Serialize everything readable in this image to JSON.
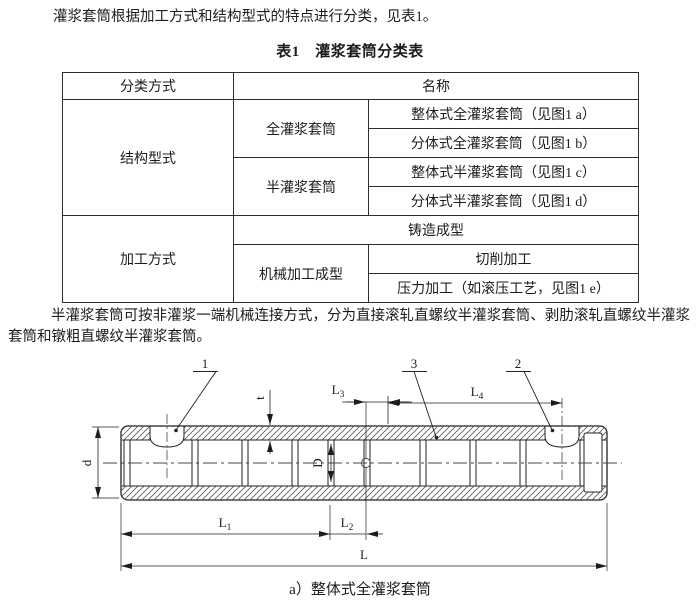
{
  "page": {
    "intro": "灌浆套筒根据加工方式和结构型式的特点进行分类，见表1。",
    "para2": "半灌浆套筒可按非灌浆一端机械连接方式，分为直接滚轧直螺纹半灌浆套筒、剥肋滚轧直螺纹半灌浆套筒和镦粗直螺纹半灌浆套筒。"
  },
  "table": {
    "title": "表1　灌浆套筒分类表",
    "headers": {
      "method": "分类方式",
      "name": "名称"
    },
    "rows": {
      "structure": "结构型式",
      "full": "全灌浆套筒",
      "half": "半灌浆套筒",
      "full_integral": "整体式全灌浆套筒（见图1 a）",
      "full_split": "分体式全灌浆套筒（见图1 b）",
      "half_integral": "整体式半灌浆套筒（见图1 c）",
      "half_split": "分体式半灌浆套筒（见图1 d）",
      "process": "加工方式",
      "casting": "铸造成型",
      "machining": "机械加工成型",
      "cutting": "切削加工",
      "pressing": "压力加工（如滚压工艺，见图1 e）"
    }
  },
  "figure": {
    "caption": "a）整体式全灌浆套筒",
    "callouts": {
      "c1": "1",
      "c2": "2",
      "c3": "3"
    },
    "dims": {
      "d": "d",
      "D": "D",
      "t": "t",
      "L": "L",
      "L1_main": "L",
      "L1_sub": "1",
      "L2_main": "L",
      "L2_sub": "2",
      "L3_main": "L",
      "L3_sub": "3",
      "L4_main": "L",
      "L4_sub": "4"
    }
  }
}
